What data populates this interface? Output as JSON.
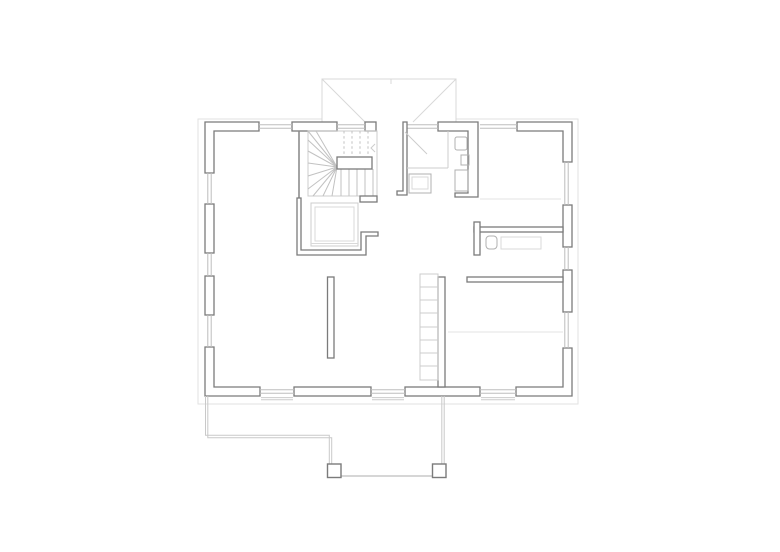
{
  "drawing": {
    "kind": "architectural-floor-plan",
    "visible_text": "",
    "features": [
      "exterior-walls",
      "window-glazing",
      "porch-roof-outline",
      "eave-overhang-line",
      "winder-stair",
      "stair-handrail",
      "elevator-shaft",
      "bathroom",
      "shower",
      "washbasin",
      "toilet",
      "bathtub",
      "wc-room",
      "wc-sink",
      "wc-counter",
      "bedroom",
      "wardrobe-shelf",
      "kitchen-island",
      "terrace",
      "terrace-posts",
      "threshold-lines",
      "ceiling-height-lines"
    ]
  },
  "colors": {
    "bg": "#ffffff",
    "wall": "#7b7b7b",
    "wall-fill": "#ffffff",
    "thin": "#8d8d8d",
    "fixture": "#b0b0b0",
    "fixture-light": "#cccccc",
    "fixture-lighter": "#d9d9d9",
    "glazing": "#bdbdbd",
    "tread": "#c2c2c2",
    "terrace": "#c9c9c9",
    "roof": "#d8d8d8",
    "eave": "#e2e2e2",
    "faint": "#e3e3e3"
  }
}
